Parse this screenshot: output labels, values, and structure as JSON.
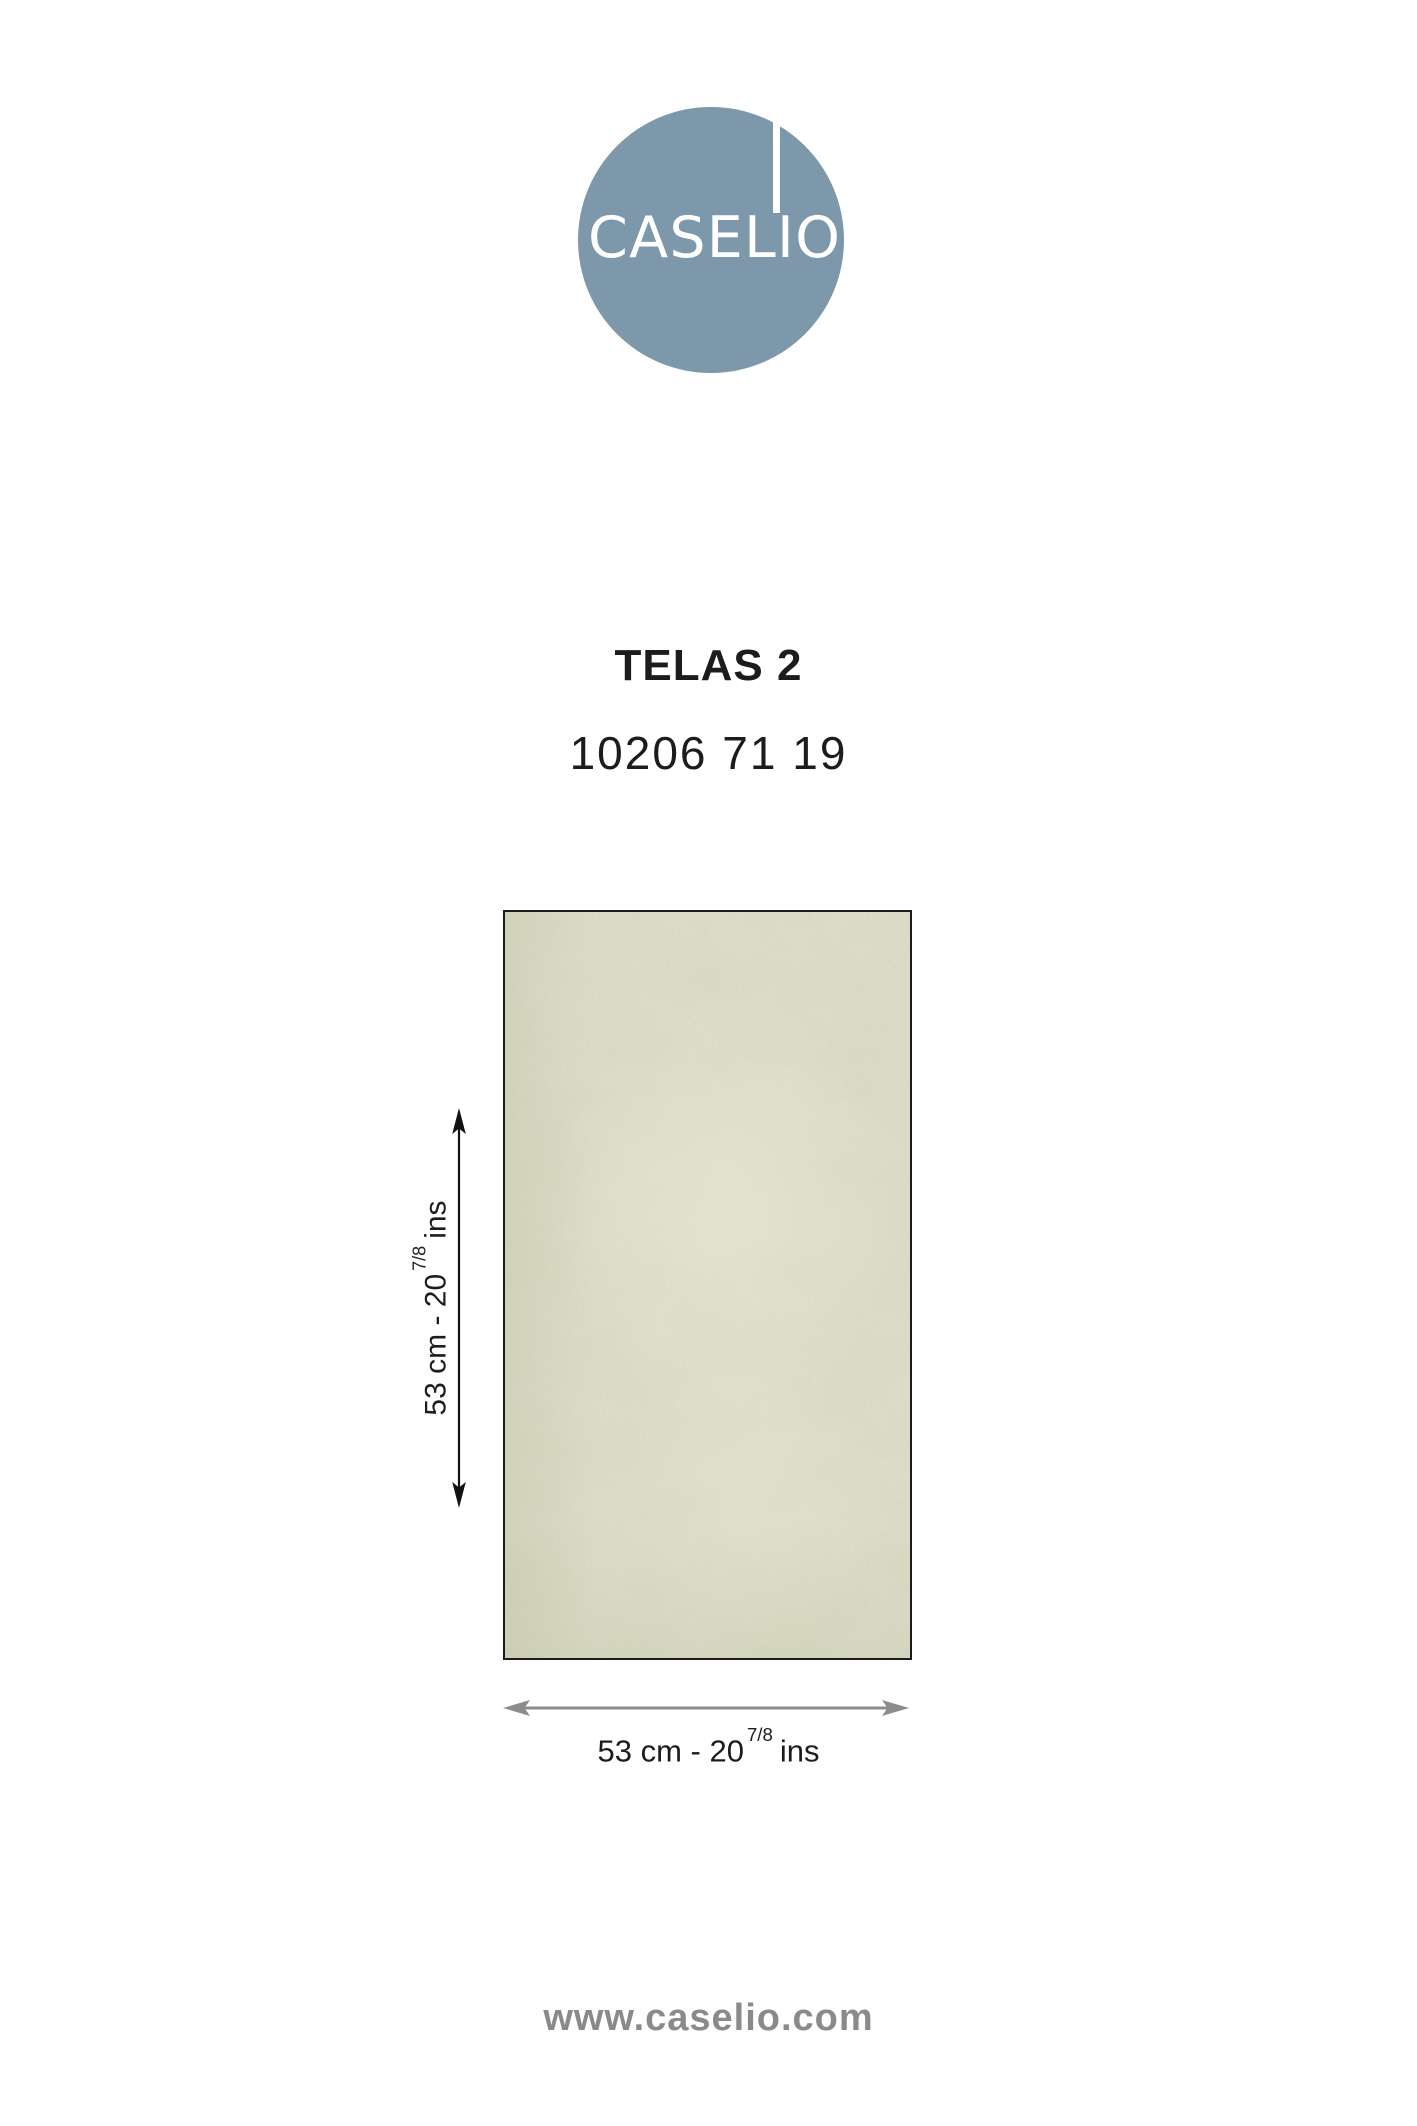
{
  "colors": {
    "brand-circle": "#7D98AB",
    "ink": "#1C1C1C",
    "swatch-base": "#DBDAC6",
    "swatch-border": "#1B1B1B",
    "arrow-black": "#121212",
    "arrow-gray": "#8C8C8C",
    "footer-gray": "#8A8A8A"
  },
  "logo": {
    "wordmark": "CASELIO"
  },
  "product": {
    "collection": "TELAS 2",
    "reference": "10206 71 19"
  },
  "dimensions": {
    "height": {
      "prefix": "53 cm - 20",
      "fraction": "7/8",
      "suffix": "ins"
    },
    "width": {
      "prefix": "53 cm - 20",
      "fraction": "7/8",
      "suffix": "ins"
    }
  },
  "footer": {
    "website": "www.caselio.com"
  }
}
